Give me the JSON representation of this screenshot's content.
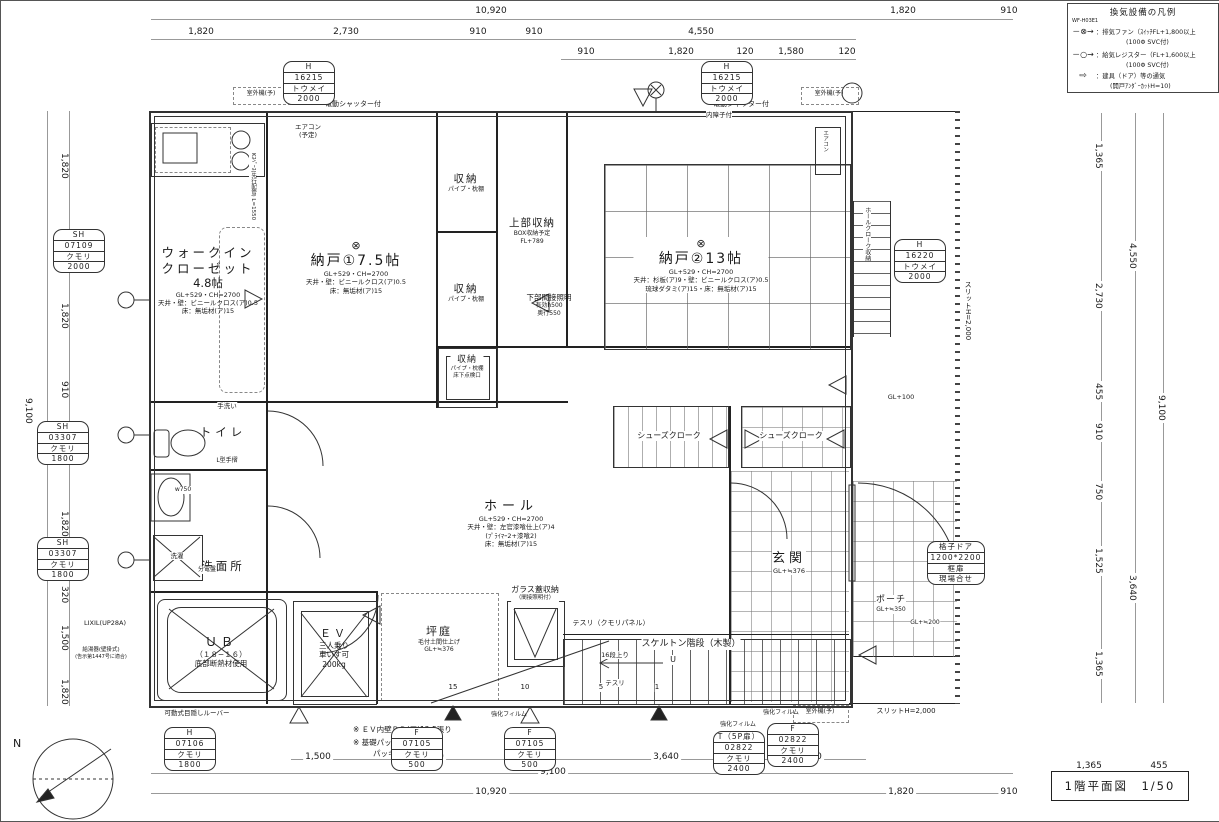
{
  "sheet": {
    "title": "1階平面図　1/50"
  },
  "legend": {
    "title": "換気設備の凡例",
    "code": "WF-H03E1",
    "items": [
      {
        "symbol": "－⊗→",
        "line1": "：排気ファン（ｽｲｯﾁFL+1,800以上",
        "line2": "(100Φ SVC付)"
      },
      {
        "symbol": "－○→",
        "line1": "：給気レジスター（FL+1,600以上",
        "line2": "(100Φ SVC付)"
      },
      {
        "symbol": "⇨",
        "line1": "：建具（ドア）等の通気",
        "line2": "(開戸ｱﾝﾀﾞｰｶｯﾄH=10)"
      }
    ]
  },
  "rooms": {
    "wic": {
      "lines": [
        "ウォークイン",
        "クローゼット",
        "4.8帖",
        "GL+529・CH=2700",
        "天井・壁：ビニールクロス(ア)0.5",
        "床：無垢材(ア)15"
      ]
    },
    "nando1": {
      "lines": [
        "⊗",
        "納戸①7.5帖",
        "GL+529・CH=2700",
        "天井・壁：ビニールクロス(ア)0.5",
        "床：無垢材(ア)15"
      ]
    },
    "nando2": {
      "lines": [
        "⊗",
        "納戸②13帖",
        "GL+529・CH=2700",
        "天井：杉板(ア)9・壁：ビニールクロス(ア)0.5",
        "琉球ダタミ(ア)15・床：無垢材(ア)15"
      ]
    },
    "hall": {
      "lines": [
        "ホール",
        "GL+529・CH=2700",
        "天井・壁：左官漆喰仕上(ア)4",
        "(ﾌﾟﾗｲﾏｰ2+漆喰2)",
        "床：無垢材(ア)15"
      ]
    },
    "toilet": {
      "name": "トイレ"
    },
    "washroom": {
      "name": "洗面所"
    },
    "genkan": {
      "name": "玄関",
      "gl": "GL+≒376"
    },
    "porch": {
      "name": "ポーチ",
      "gl1": "GL+≒350",
      "gl2": "GL+≒200"
    },
    "tsuboniwa": {
      "lines": [
        "坪庭",
        "毛付土間仕上げ",
        "GL+≒376"
      ]
    },
    "ub": {
      "lines": [
        "ＵＢ",
        "（１８−１６）",
        "底部断熱材使用"
      ]
    },
    "ev": {
      "lines": [
        "ＥＶ",
        "三人乗り",
        "車いす可",
        "200kg"
      ]
    },
    "shoes": {
      "name": "シューズクローク"
    },
    "sto1": {
      "lines": [
        "収納",
        "パイプ・枕棚"
      ]
    },
    "sto2": {
      "lines": [
        "収納",
        "パイプ・枕棚"
      ]
    },
    "sto3": {
      "lines": [
        "収納",
        "パイプ・枕棚",
        "床下点検口"
      ]
    },
    "upper_sto": {
      "lines": [
        "上部収納",
        "BOX収納予定",
        "FL+789"
      ]
    },
    "lower_light": {
      "lines": [
        "下部間接照明",
        "有効h500",
        "奥行550"
      ]
    },
    "stair": {
      "name": "スケルトン階段（木製）",
      "steps": "16段上り",
      "rail1": "テスリ（クモリパネル）",
      "rail2": "テスリ",
      "up": "U",
      "nums": [
        "15",
        "10",
        "5",
        "1"
      ]
    },
    "glass": {
      "lines": [
        "ガラス蓋収納",
        "（間接照明付）"
      ]
    },
    "cloak": {
      "name": "ホールクローク収納"
    }
  },
  "tags": {
    "win_top_left": [
      "H",
      "16215",
      "トウメイ",
      "2000"
    ],
    "win_top_right": [
      "H",
      "16215",
      "トウメイ",
      "2000"
    ],
    "win_right": [
      "H",
      "16220",
      "トウメイ",
      "2000"
    ],
    "win_left_top": [
      "SH",
      "07109",
      "クモリ",
      "2000"
    ],
    "win_left_mid": [
      "SH",
      "03307",
      "クモリ",
      "1800"
    ],
    "win_left_bot": [
      "SH",
      "03307",
      "クモリ",
      "1800"
    ],
    "win_bot_left": [
      "H",
      "07106",
      "クモリ",
      "1800"
    ],
    "win_bot_mid1": [
      "F",
      "07105",
      "クモリ",
      "500"
    ],
    "win_bot_mid2": [
      "F",
      "07105",
      "クモリ",
      "500"
    ],
    "door_bot_entry": [
      "T（5P扉）",
      "02822",
      "クモリ",
      "2400"
    ],
    "win_bot_right": [
      "F",
      "02822",
      "クモリ",
      "2400"
    ],
    "door_entry": [
      "格子ドア",
      "1200*2200",
      "框扉",
      "現場合せ"
    ]
  },
  "labels": {
    "shutter": "電動シャッター付",
    "outdoor_unit": "室外機(予)",
    "aircon1": "エアコン",
    "aircon2": "(予定)",
    "inner_shoji": "内障子付",
    "k_space": "Kｽﾍﾟｰｽ(先行配管) L=1550",
    "tearai": "手洗い",
    "l_grip": "L型手摺",
    "w750": "w750",
    "laundry": "洗濯",
    "panel": "分電盤",
    "lixil": "LIXIL(UP28A)",
    "heater1": "給湯器(壁掛式)",
    "heater2": "(告示第1447号に適合)",
    "louver": "可動式目隠しルーバー",
    "note_ev": "※ ＥＶ内壁ＰＢ(ア)12.5張り",
    "note_packing1": "※ 基礎パッキンは気密",
    "note_packing2": "パッキンとする事",
    "gl100": "GL+100",
    "slit_right": "スリットH=2,000",
    "slit_bottom": "スリットH=2,000",
    "film": "強化フィルム",
    "compass_n": "N"
  },
  "dims": {
    "top1": [
      "10,920",
      "1,820",
      "910"
    ],
    "top2": [
      "1,820",
      "2,730",
      "910",
      "910",
      "4,550"
    ],
    "top3": [
      "910",
      "1,820",
      "120",
      "1,580",
      "120"
    ],
    "bottom1": [
      "1,500",
      "2,140",
      "3,640",
      "1,820"
    ],
    "bottom2": [
      "9,100",
      "1,365",
      "455"
    ],
    "bottom3": [
      "10,920",
      "1,820",
      "910"
    ],
    "left_outer": "9,100",
    "left": [
      "1,820",
      "4,350",
      "1,820",
      "910",
      "1,110",
      "1,820",
      "320",
      "1,500",
      "1,820"
    ],
    "right": [
      "1,365",
      "2,730",
      "455",
      "910",
      "750",
      "1,525",
      "1,365"
    ],
    "right_outer": [
      "4,550",
      "3,640"
    ],
    "right_far": "9,100"
  }
}
